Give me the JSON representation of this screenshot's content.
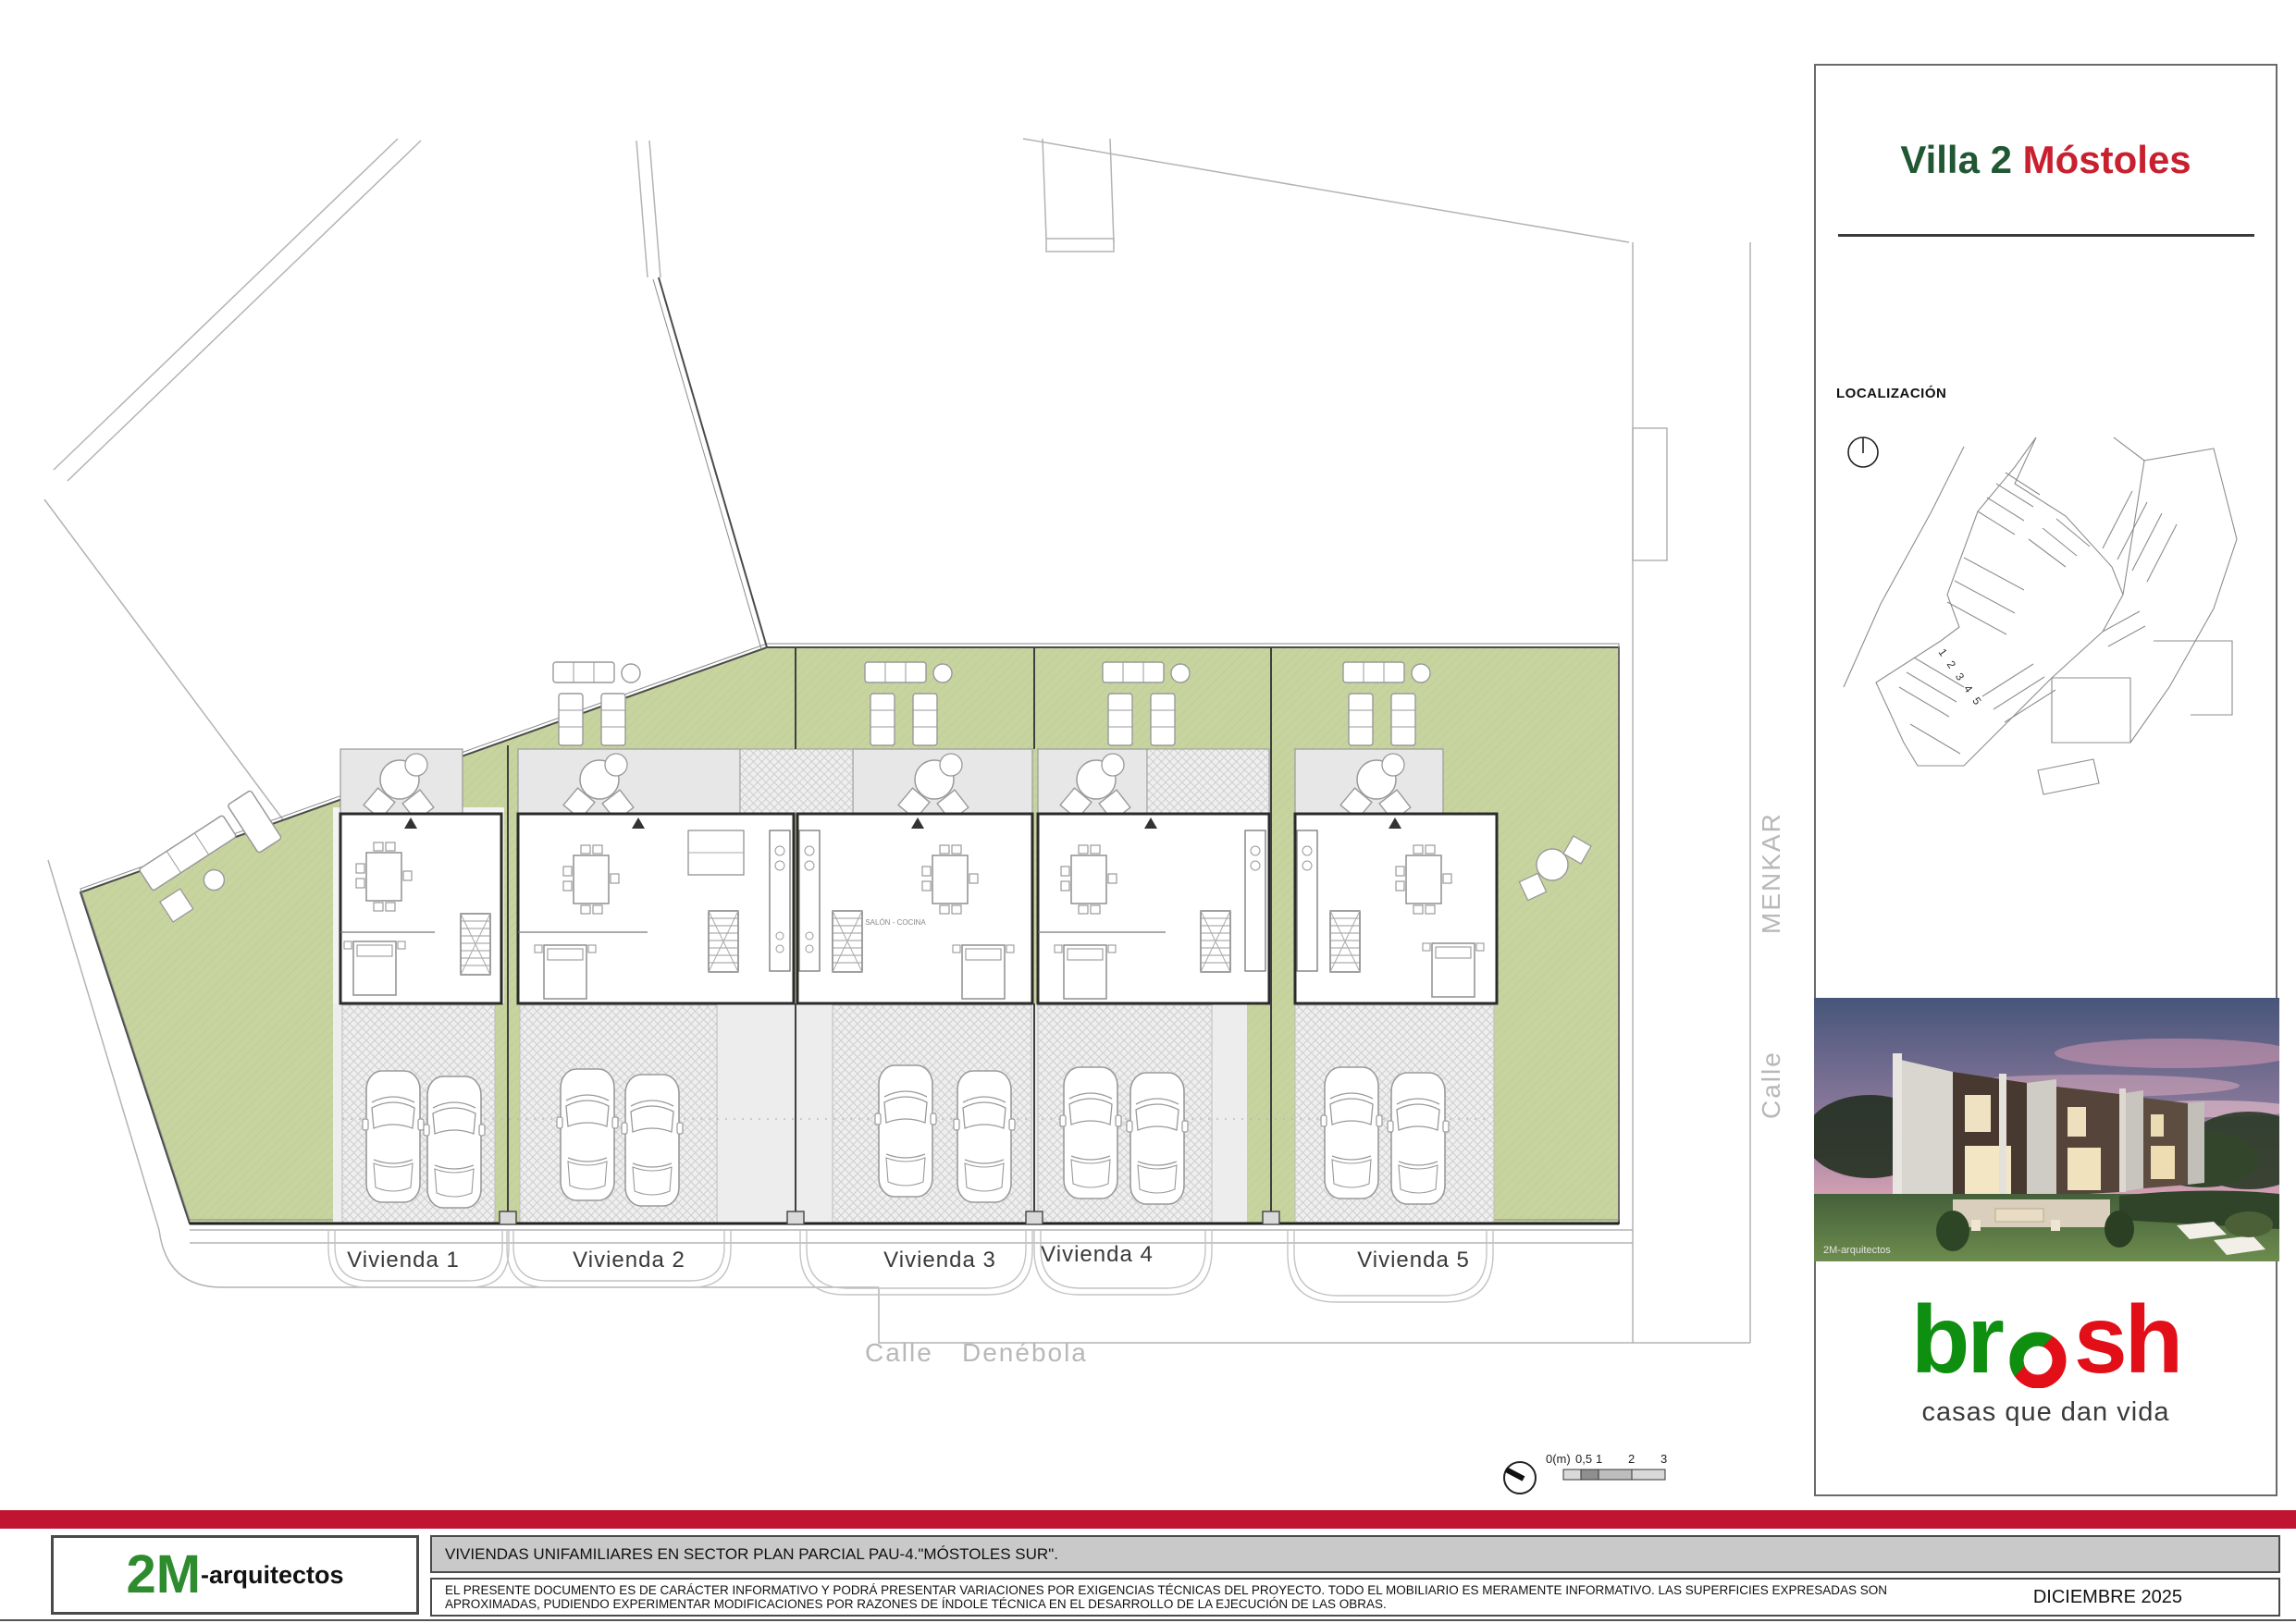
{
  "title_block": {
    "project_title_part1": "Villa 2",
    "project_title_part2": "Móstoles",
    "localization_label": "LOCALIZACIÓN",
    "map_lot_numbers": "1 2 3 4 5",
    "render_watermark": "2M-arquitectos",
    "brand": {
      "logo_part1": "br",
      "logo_part2": "sh",
      "tagline": "casas que dan vida",
      "green": "#0f8f0f",
      "red": "#e20e18"
    }
  },
  "plan": {
    "viviendas": [
      {
        "label": "Vivienda 1"
      },
      {
        "label": "Vivienda 2"
      },
      {
        "label": "Vivienda 3"
      },
      {
        "label": "Vivienda 4"
      },
      {
        "label": "Vivienda 5"
      }
    ],
    "streets": {
      "bottom_prefix": "Calle",
      "bottom_name": "Denébola",
      "right_prefix": "Calle",
      "right_name": "MENKAR"
    },
    "room_label": "SALÓN - COCINA",
    "scale_bar": {
      "label0": "0(m)",
      "label05": "0,5",
      "label1": "1",
      "label2": "2",
      "label3": "3"
    },
    "colors": {
      "garden_green": "#c8d4a0",
      "terrace_gray": "#e7e7e7",
      "driveway_gray": "#ededed"
    }
  },
  "footer": {
    "firm_logo_big": "2M",
    "firm_logo_small": "-arquitectos",
    "firm_green": "#2e8b2e",
    "project_name": "VIVIENDAS UNIFAMILIARES EN SECTOR PLAN PARCIAL PAU-4.\"MÓSTOLES SUR\".",
    "disclaimer": "EL PRESENTE DOCUMENTO ES DE CARÁCTER INFORMATIVO Y PODRÁ PRESENTAR VARIACIONES POR EXIGENCIAS TÉCNICAS DEL PROYECTO. TODO EL MOBILIARIO ES MERAMENTE INFORMATIVO. LAS SUPERFICIES EXPRESADAS SON APROXIMADAS, PUDIENDO EXPERIMENTAR MODIFICACIONES POR RAZONES DE ÍNDOLE TÉCNICA EN EL DESARROLLO DE LA EJECUCIÓN DE LAS OBRAS.",
    "date": "DICIEMBRE 2025",
    "accent_red": "#c01432"
  }
}
